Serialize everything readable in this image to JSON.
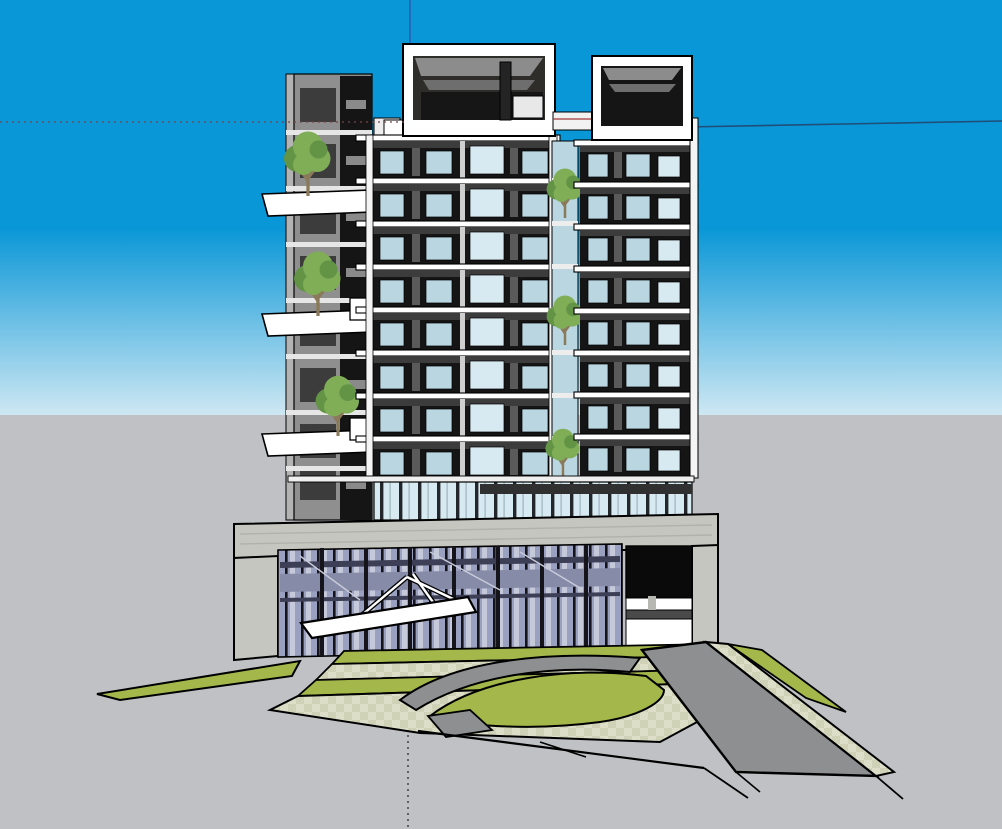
{
  "app": {
    "name": "3d-model-viewport",
    "description": "SketchUp-style 3D architectural model of a mixed-use residential tower with glazed podium, drop-off driveway and landscaped site"
  },
  "colors": {
    "sky_top": "#0a97d7",
    "sky_horizon": "#cfe8f3",
    "ground": "#bfc1c4",
    "outline": "#000000",
    "facade_dark": "#151515",
    "facade_panel": "#3c3c3c",
    "facade_gray": "#8f8f8f",
    "facade_light": "#b3b3b3",
    "slab_white": "#ffffff",
    "slab_off": "#ececec",
    "glass_light": "#b9d6e1",
    "glass_bright": "#d7eaf1",
    "curtain_glass": "#9aa0c0",
    "curtain_stripe": "#c6c9da",
    "curtain_band": "#868ba8",
    "curtain_dark": "#3c3f55",
    "mullion": "#14141a",
    "concrete": "#c6c6c0",
    "concrete_shade": "#b2b2ac",
    "grass": "#a4b74b",
    "paving": "#dcdec8",
    "paving_check": "#d0d2b8",
    "road": "#8d8f91",
    "opening_dark": "#0a0a0a",
    "beam_gray": "#4a4a4a",
    "roof_gray": "#8c8c8c",
    "roof_gray_dark": "#6e6e6e",
    "tree_foliage": "#7fae57",
    "tree_foliage_dark": "#639446",
    "tree_trunk": "#8a7a5a",
    "axis_blue": "#2b5fb4",
    "axis_navy": "#1f4e79",
    "axis_dotted": "#774444",
    "axis_dotted_dark": "#3a3a3a",
    "canopy_white": "#ffffff"
  },
  "scene": {
    "viewport": {
      "width": 1002,
      "height": 829,
      "horizon_y": 415
    },
    "building": {
      "tower_floor_modules": 8,
      "rooftop_pavilions": 2,
      "left_wing_balconies": 3,
      "balcony_trees": 6,
      "podium": {
        "has_curtain_wall": true,
        "has_canopy": true,
        "has_garage_opening": true
      }
    },
    "site": {
      "green_strips": 5,
      "checker_walkways": 3,
      "circular_dropoff": true,
      "road_direction": "lower-right"
    },
    "axes": {
      "vertical_blue_x": 410,
      "horizontal_navy_y": 124,
      "dotted_left_y": 122,
      "dotted_bottom_x": 408
    }
  }
}
